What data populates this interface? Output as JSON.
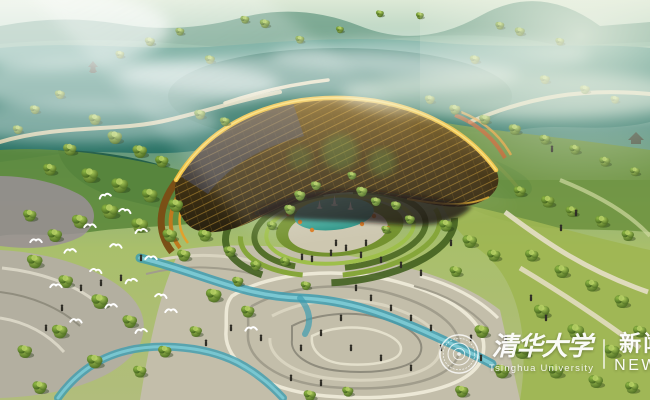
{
  "watermark": {
    "university_cn": "清华大学",
    "university_en": "Tsinghua University",
    "news_cn": "新闻",
    "news_en": "NEWS"
  },
  "palette": {
    "lake_teal": "#2a7265",
    "dark_inlet": "#1e5a46",
    "mist_white": "#edf3e6",
    "canopy_gold": "#eec043",
    "canopy_face_dark": "#3c2f16",
    "canopy_blue_sheen": "#54639c",
    "pond_turquoise": "#3fb0a0",
    "stream_turquoise": "#3f9db0",
    "tree_green": "#4e7128",
    "lawn_green": "#9fb652",
    "plaza_beige": "#c3beaa",
    "plaza_mauve": "#9a8f96",
    "flowerbed_orange": "#c85a28"
  },
  "scene": {
    "trees": [
      [
        120,
        55,
        0.8
      ],
      [
        150,
        42,
        0.9
      ],
      [
        180,
        32,
        0.8
      ],
      [
        210,
        60,
        0.9
      ],
      [
        225,
        122,
        0.9
      ],
      [
        245,
        20,
        0.8
      ],
      [
        265,
        24,
        0.9
      ],
      [
        300,
        40,
        0.8
      ],
      [
        340,
        30,
        0.7
      ],
      [
        380,
        14,
        0.7
      ],
      [
        420,
        16,
        0.7
      ],
      [
        475,
        60,
        0.9
      ],
      [
        500,
        26,
        0.8
      ],
      [
        520,
        32,
        0.9
      ],
      [
        545,
        80,
        0.9
      ],
      [
        560,
        42,
        0.8
      ],
      [
        585,
        90,
        0.9
      ],
      [
        615,
        100,
        0.8
      ],
      [
        430,
        100,
        0.9
      ],
      [
        455,
        110,
        1.0
      ],
      [
        485,
        120,
        1.0
      ],
      [
        515,
        130,
        1.1
      ],
      [
        545,
        140,
        1.0
      ],
      [
        575,
        150,
        1.0
      ],
      [
        605,
        162,
        1.0
      ],
      [
        635,
        172,
        0.9
      ],
      [
        60,
        95,
        0.9
      ],
      [
        35,
        110,
        0.9
      ],
      [
        18,
        130,
        0.9
      ],
      [
        95,
        120,
        1.1
      ],
      [
        200,
        115,
        1.0
      ],
      [
        70,
        150,
        1.2
      ],
      [
        50,
        170,
        1.2
      ],
      [
        115,
        138,
        1.3
      ],
      [
        140,
        152,
        1.3
      ],
      [
        162,
        162,
        1.2
      ],
      [
        90,
        176,
        1.5
      ],
      [
        120,
        186,
        1.5
      ],
      [
        150,
        196,
        1.4
      ],
      [
        176,
        206,
        1.3
      ],
      [
        110,
        212,
        1.5
      ],
      [
        80,
        222,
        1.4
      ],
      [
        55,
        236,
        1.3
      ],
      [
        30,
        216,
        1.2
      ],
      [
        140,
        226,
        1.5
      ],
      [
        170,
        236,
        1.3
      ],
      [
        205,
        236,
        1.2
      ],
      [
        230,
        252,
        1.1
      ],
      [
        256,
        266,
        1.0
      ],
      [
        285,
        262,
        0.9
      ],
      [
        184,
        256,
        1.2
      ],
      [
        300,
        196,
        1.0
      ],
      [
        316,
        186,
        0.9
      ],
      [
        290,
        210,
        1.0
      ],
      [
        352,
        176,
        0.8
      ],
      [
        362,
        192,
        1.0
      ],
      [
        376,
        202,
        0.9
      ],
      [
        396,
        206,
        0.9
      ],
      [
        272,
        226,
        0.9
      ],
      [
        410,
        220,
        0.9
      ],
      [
        386,
        230,
        0.8
      ],
      [
        446,
        226,
        1.2
      ],
      [
        470,
        242,
        1.3
      ],
      [
        494,
        256,
        1.2
      ],
      [
        456,
        272,
        1.1
      ],
      [
        520,
        192,
        1.1
      ],
      [
        548,
        202,
        1.2
      ],
      [
        572,
        212,
        1.1
      ],
      [
        602,
        222,
        1.2
      ],
      [
        628,
        236,
        1.1
      ],
      [
        532,
        256,
        1.2
      ],
      [
        562,
        272,
        1.3
      ],
      [
        592,
        286,
        1.2
      ],
      [
        622,
        302,
        1.3
      ],
      [
        542,
        312,
        1.4
      ],
      [
        576,
        332,
        1.5
      ],
      [
        612,
        352,
        1.4
      ],
      [
        640,
        332,
        1.2
      ],
      [
        522,
        352,
        1.5
      ],
      [
        556,
        372,
        1.4
      ],
      [
        596,
        382,
        1.3
      ],
      [
        632,
        388,
        1.2
      ],
      [
        482,
        332,
        1.3
      ],
      [
        502,
        372,
        1.4
      ],
      [
        462,
        392,
        1.2
      ],
      [
        35,
        262,
        1.4
      ],
      [
        66,
        282,
        1.3
      ],
      [
        100,
        302,
        1.5
      ],
      [
        130,
        322,
        1.3
      ],
      [
        60,
        332,
        1.4
      ],
      [
        25,
        352,
        1.3
      ],
      [
        95,
        362,
        1.4
      ],
      [
        140,
        372,
        1.2
      ],
      [
        40,
        388,
        1.3
      ],
      [
        165,
        352,
        1.2
      ],
      [
        214,
        296,
        1.4
      ],
      [
        248,
        312,
        1.2
      ],
      [
        306,
        286,
        0.9
      ],
      [
        196,
        332,
        1.1
      ],
      [
        238,
        282,
        1.0
      ],
      [
        348,
        392,
        1.0
      ],
      [
        310,
        396,
        1.1
      ]
    ],
    "people": [
      [
        302,
        260
      ],
      [
        312,
        262
      ],
      [
        331,
        256
      ],
      [
        346,
        251
      ],
      [
        361,
        258
      ],
      [
        381,
        263
      ],
      [
        401,
        268
      ],
      [
        421,
        276
      ],
      [
        356,
        291
      ],
      [
        371,
        301
      ],
      [
        391,
        311
      ],
      [
        411,
        321
      ],
      [
        431,
        331
      ],
      [
        341,
        321
      ],
      [
        321,
        336
      ],
      [
        301,
        351
      ],
      [
        351,
        351
      ],
      [
        381,
        361
      ],
      [
        411,
        371
      ],
      [
        441,
        351
      ],
      [
        471,
        341
      ],
      [
        291,
        381
      ],
      [
        321,
        386
      ],
      [
        261,
        341
      ],
      [
        231,
        331
      ],
      [
        206,
        346
      ],
      [
        121,
        281
      ],
      [
        101,
        286
      ],
      [
        141,
        261
      ],
      [
        81,
        291
      ],
      [
        531,
        301
      ],
      [
        546,
        321
      ],
      [
        506,
        341
      ],
      [
        481,
        361
      ],
      [
        561,
        231
      ],
      [
        576,
        216
      ],
      [
        451,
        246
      ],
      [
        62,
        311
      ],
      [
        46,
        331
      ],
      [
        552,
        152
      ],
      [
        366,
        246
      ],
      [
        336,
        246
      ]
    ],
    "birds": [
      [
        105,
        196,
        -15
      ],
      [
        125,
        211,
        10
      ],
      [
        90,
        226,
        0
      ],
      [
        141,
        231,
        -10
      ],
      [
        116,
        246,
        6
      ],
      [
        70,
        251,
        -6
      ],
      [
        151,
        258,
        0
      ],
      [
        96,
        271,
        10
      ],
      [
        131,
        281,
        -12
      ],
      [
        56,
        286,
        0
      ],
      [
        161,
        296,
        8
      ],
      [
        111,
        306,
        -6
      ],
      [
        76,
        321,
        4
      ],
      [
        141,
        331,
        -8
      ],
      [
        171,
        311,
        0
      ],
      [
        36,
        241,
        0
      ],
      [
        251,
        329,
        -5
      ]
    ]
  }
}
